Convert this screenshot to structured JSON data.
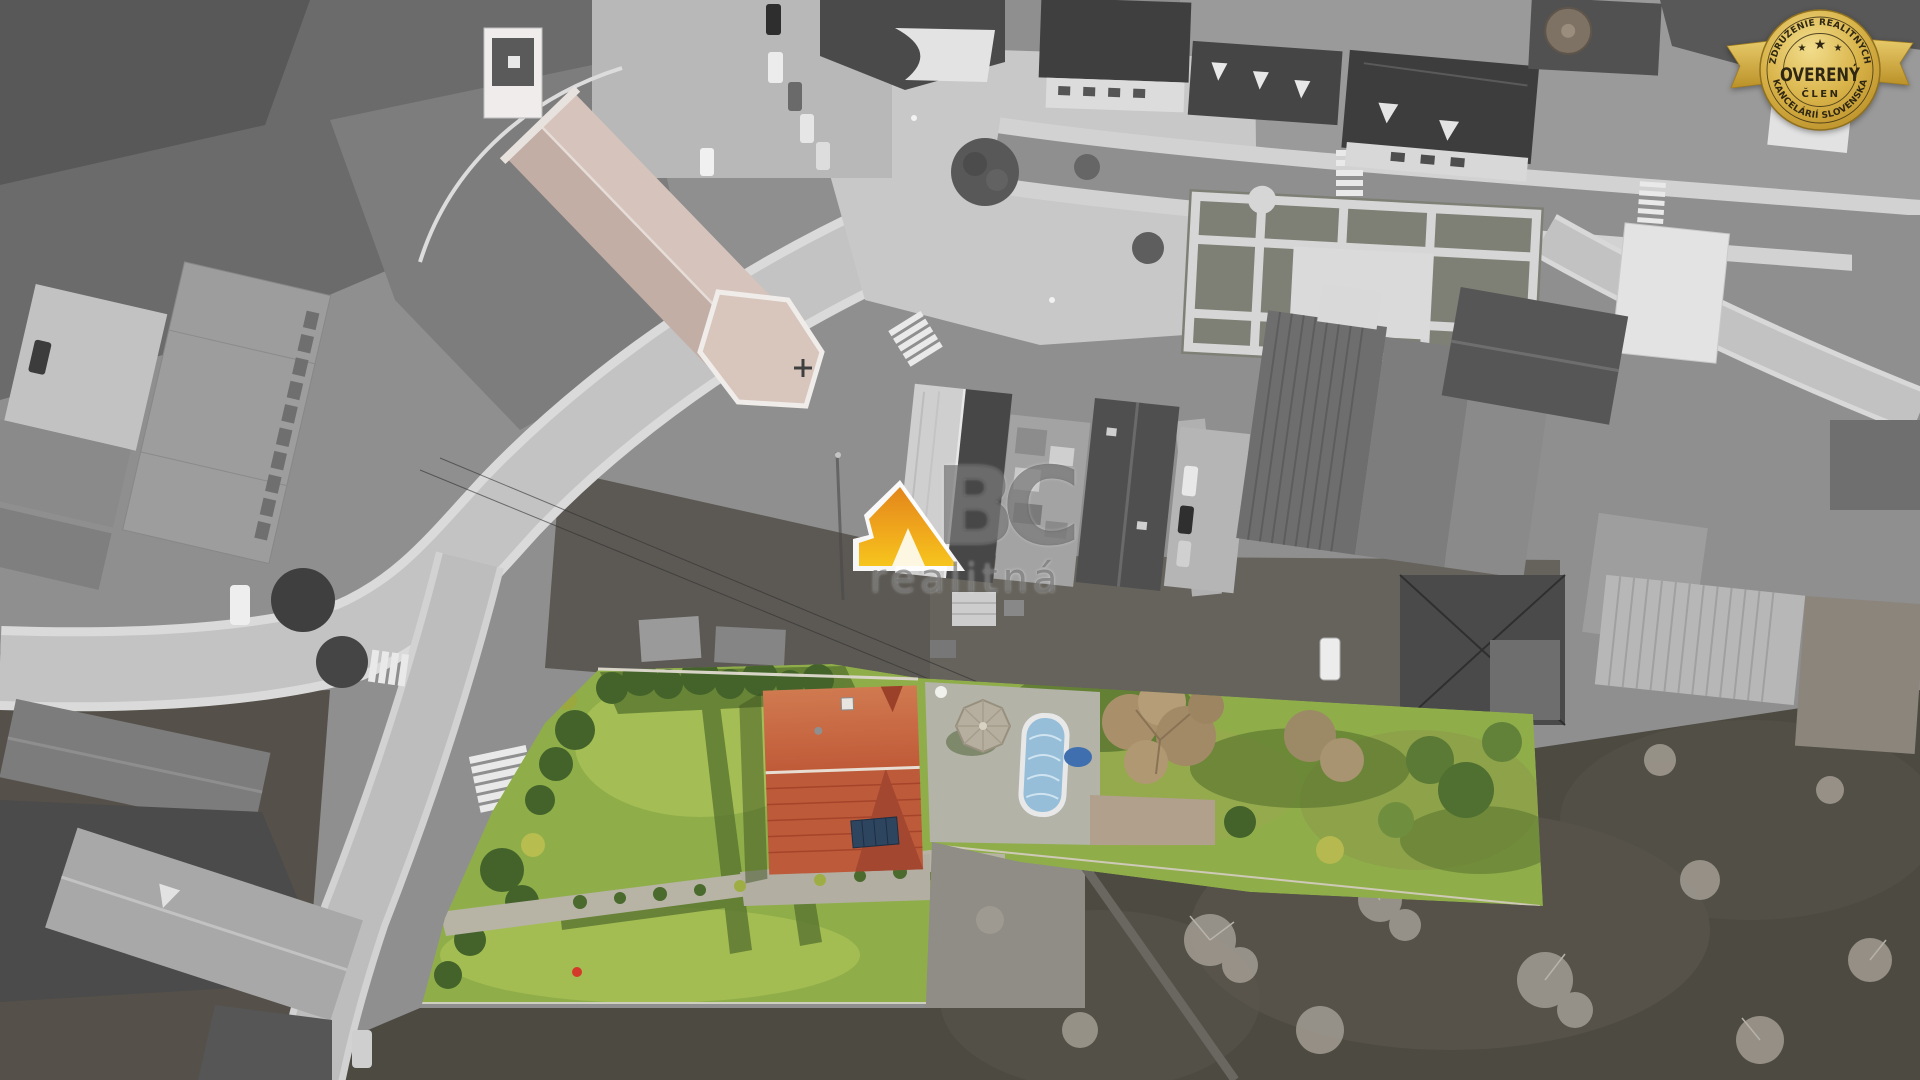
{
  "badge": {
    "arc_top": "ZDRUŽENIE REALITNÝCH",
    "arc_bottom": "KANCELÁRIÍ SLOVENSKA",
    "title": "OVERENÝ",
    "subtitle": "ČLEN",
    "star": "★"
  },
  "watermark": {
    "letter_b": "B",
    "letter_c": "C",
    "tagline": "realitná"
  },
  "colors": {
    "badge_gold": "#d9b44a",
    "badge_gold_dark": "#b08a24",
    "badge_text": "#2f2713",
    "logo_orange": "#e8891b",
    "logo_yellow": "#f6c51d",
    "grass_green": "#8fae4a",
    "grass_light": "#a9c257",
    "grass_shadow": "#55702e",
    "roof_red": "#bc5a3a",
    "roof_red_dark": "#a34730",
    "pool_blue": "#96bed8",
    "watermark_gray": "#6f6f6f"
  }
}
